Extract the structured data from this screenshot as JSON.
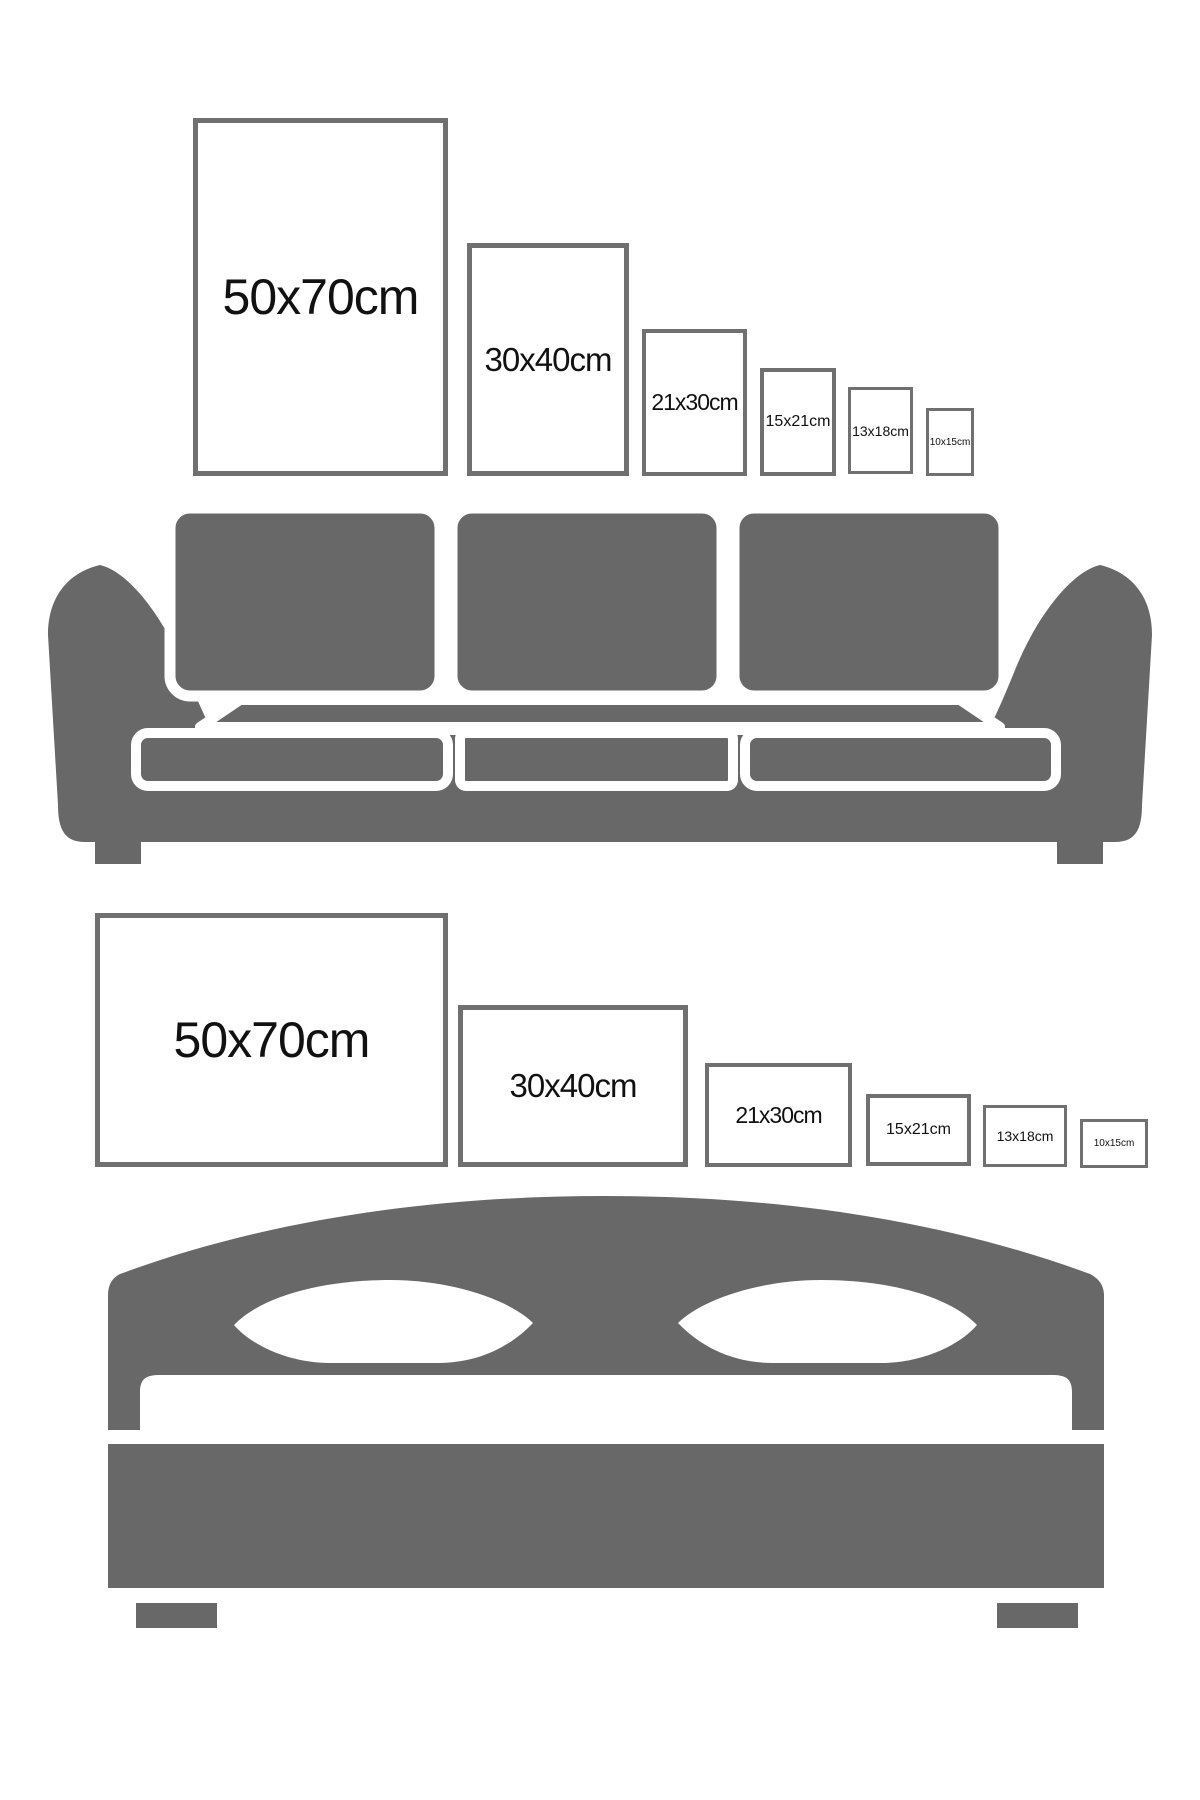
{
  "colors": {
    "furniture_gray": "#686868",
    "frame_border": "#707070",
    "label_text": "#111111",
    "background": "#ffffff"
  },
  "sofa_section": {
    "furniture": "sofa",
    "frames": [
      {
        "label": "50x70cm",
        "orientation": "portrait"
      },
      {
        "label": "30x40cm",
        "orientation": "portrait"
      },
      {
        "label": "21x30cm",
        "orientation": "portrait"
      },
      {
        "label": "15x21cm",
        "orientation": "portrait"
      },
      {
        "label": "13x18cm",
        "orientation": "portrait"
      },
      {
        "label": "10x15cm",
        "orientation": "portrait"
      }
    ]
  },
  "bed_section": {
    "furniture": "bed",
    "frames": [
      {
        "label": "50x70cm",
        "orientation": "landscape"
      },
      {
        "label": "30x40cm",
        "orientation": "landscape"
      },
      {
        "label": "21x30cm",
        "orientation": "landscape"
      },
      {
        "label": "15x21cm",
        "orientation": "landscape"
      },
      {
        "label": "13x18cm",
        "orientation": "landscape"
      },
      {
        "label": "10x15cm",
        "orientation": "landscape"
      }
    ]
  }
}
